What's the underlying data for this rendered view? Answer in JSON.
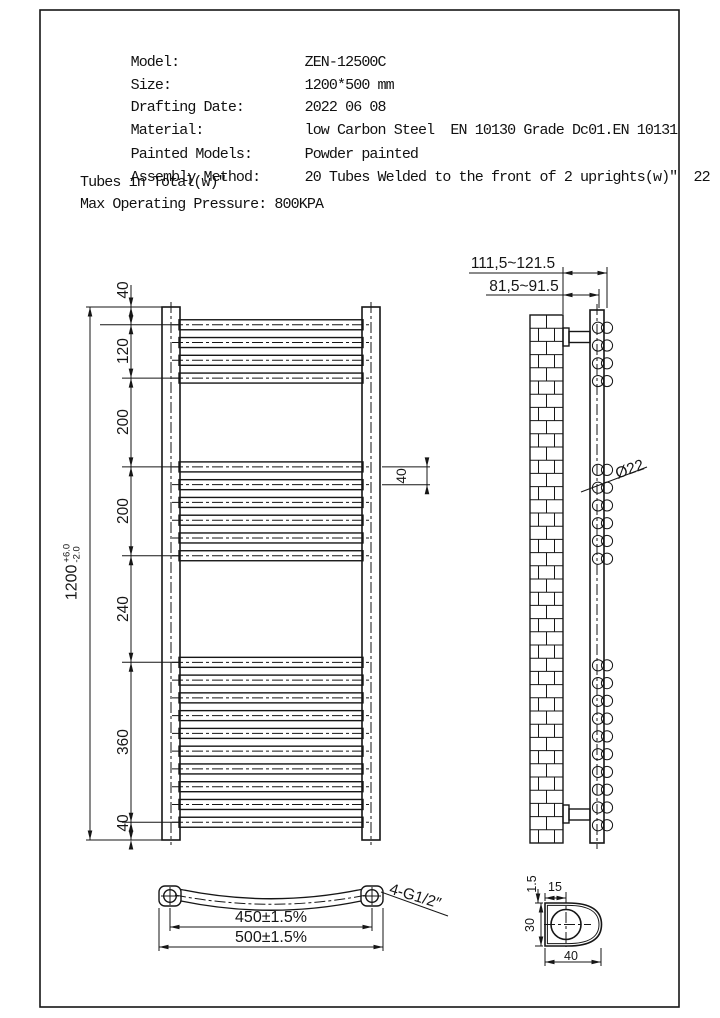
{
  "spec": {
    "rows": [
      {
        "label": "Model:",
        "value": "ZEN-12500C"
      },
      {
        "label": "Size:",
        "value": "1200*500 mm"
      },
      {
        "label": "Drafting Date:",
        "value": "2022 06 08"
      },
      {
        "label": "Material:",
        "value": "low Carbon Steel  EN 10130 Grade Dc01.EN 10131"
      },
      {
        "label": "Painted Models:",
        "value": "Powder painted"
      },
      {
        "label": "Assembly Method:",
        "value": "20 Tubes Welded to the front of 2 uprights(w)″  22"
      }
    ],
    "assembly_overflow": "Tubes in Total(w)″",
    "pressure_line": "Max Operating Pressure: 800KPA"
  },
  "front_view": {
    "chain_dims": [
      "40",
      "120",
      "200",
      "200",
      "240",
      "360",
      "40"
    ],
    "overall_dim": {
      "value": "1200",
      "tol_plus": "+6.0",
      "tol_minus": "-2.0"
    },
    "tube_gap_dim": "40",
    "tube_groups": [
      4,
      6,
      10
    ]
  },
  "side_view": {
    "dim_wall_to_front": "111,5~121.5",
    "dim_wall_to_back": "81,5~91.5",
    "tube_diameter": "Ø22"
  },
  "bottom_view": {
    "dim_centers": "450±1.5%",
    "dim_overall": "500±1.5%",
    "connection": "4-G1/2″"
  },
  "profile_detail": {
    "dim_wall": "1.5",
    "dim_offset": "15",
    "dim_height": "30",
    "dim_width": "40"
  },
  "colors": {
    "line": "#161616",
    "background": "#ffffff"
  }
}
